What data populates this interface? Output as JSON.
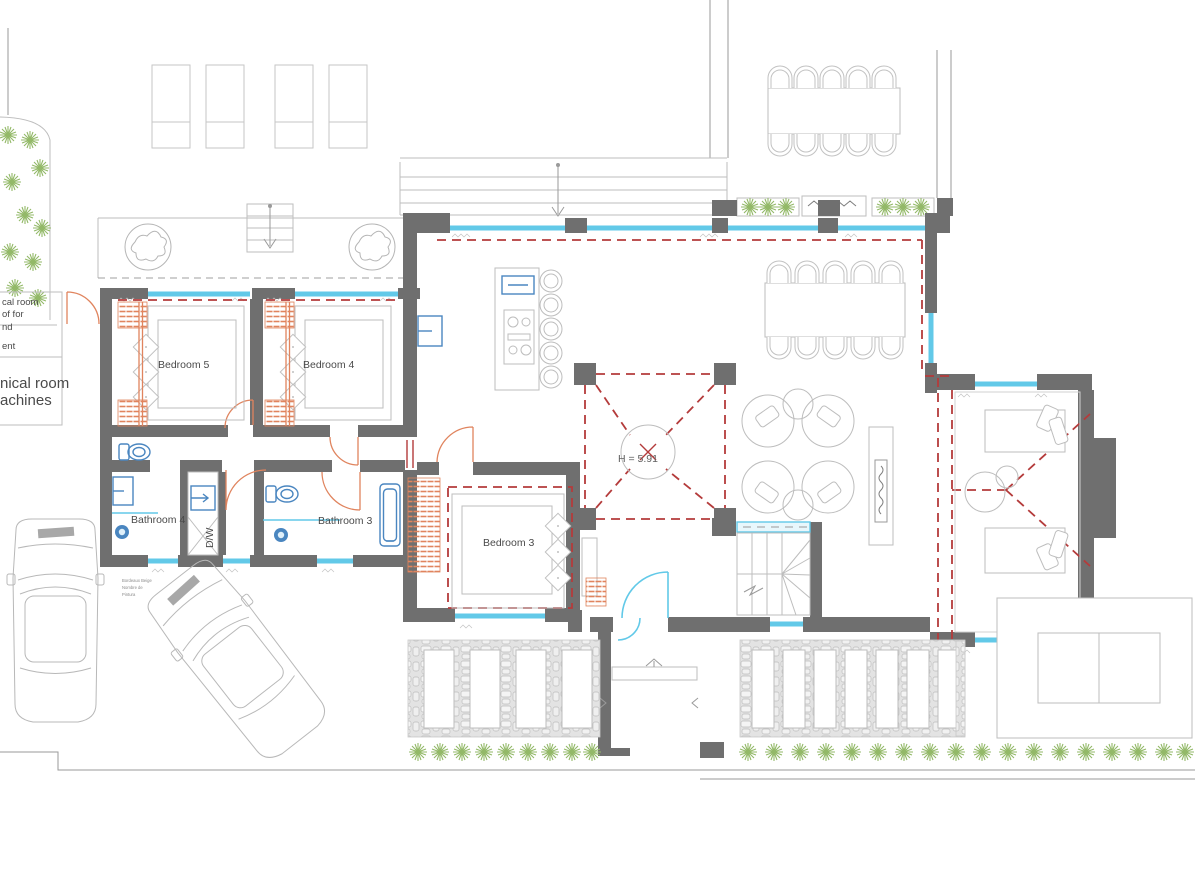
{
  "rooms": {
    "bedroom5": "Bedroom 5",
    "bedroom4": "Bedroom 4",
    "bedroom3": "Bedroom 3",
    "bathroom4": "Bathroom 4",
    "bathroom3": "Bathroom 3",
    "dishwasher_closet": "D/W"
  },
  "annotations": {
    "ceiling_height": "H = 5.91"
  },
  "clipped_text_left_edge": {
    "upper_fragments": [
      "cal room",
      "of for",
      "nd",
      "ent"
    ],
    "lower_fragments": [
      "nical room",
      "achines"
    ]
  },
  "material_note_lines": [
    "Bordeaux Beige",
    "Nombre de",
    "Pintura"
  ],
  "colors": {
    "wall": "#6f6f6f",
    "outline": "#bdbdbd",
    "glass": "#62c9e8",
    "red": "#b43b3b",
    "orange": "#e0845e",
    "green": "#93b968",
    "blue": "#4a86c0",
    "text": "#4a4a4a",
    "stone": "#e3e3e3"
  },
  "icons": {
    "fixtures": [
      "toilet-icon",
      "sink-icon",
      "bathtub-icon",
      "floor-drain-icon",
      "dishwasher-icon",
      "cooktop-icon",
      "kitchen-sink-icon",
      "fireplace-icon",
      "staircase-icon",
      "car-icon",
      "plant-icon",
      "tree-planter-icon",
      "sunbed-icon",
      "dining-chair-icon",
      "bed-icon",
      "door-swing-icon"
    ]
  }
}
